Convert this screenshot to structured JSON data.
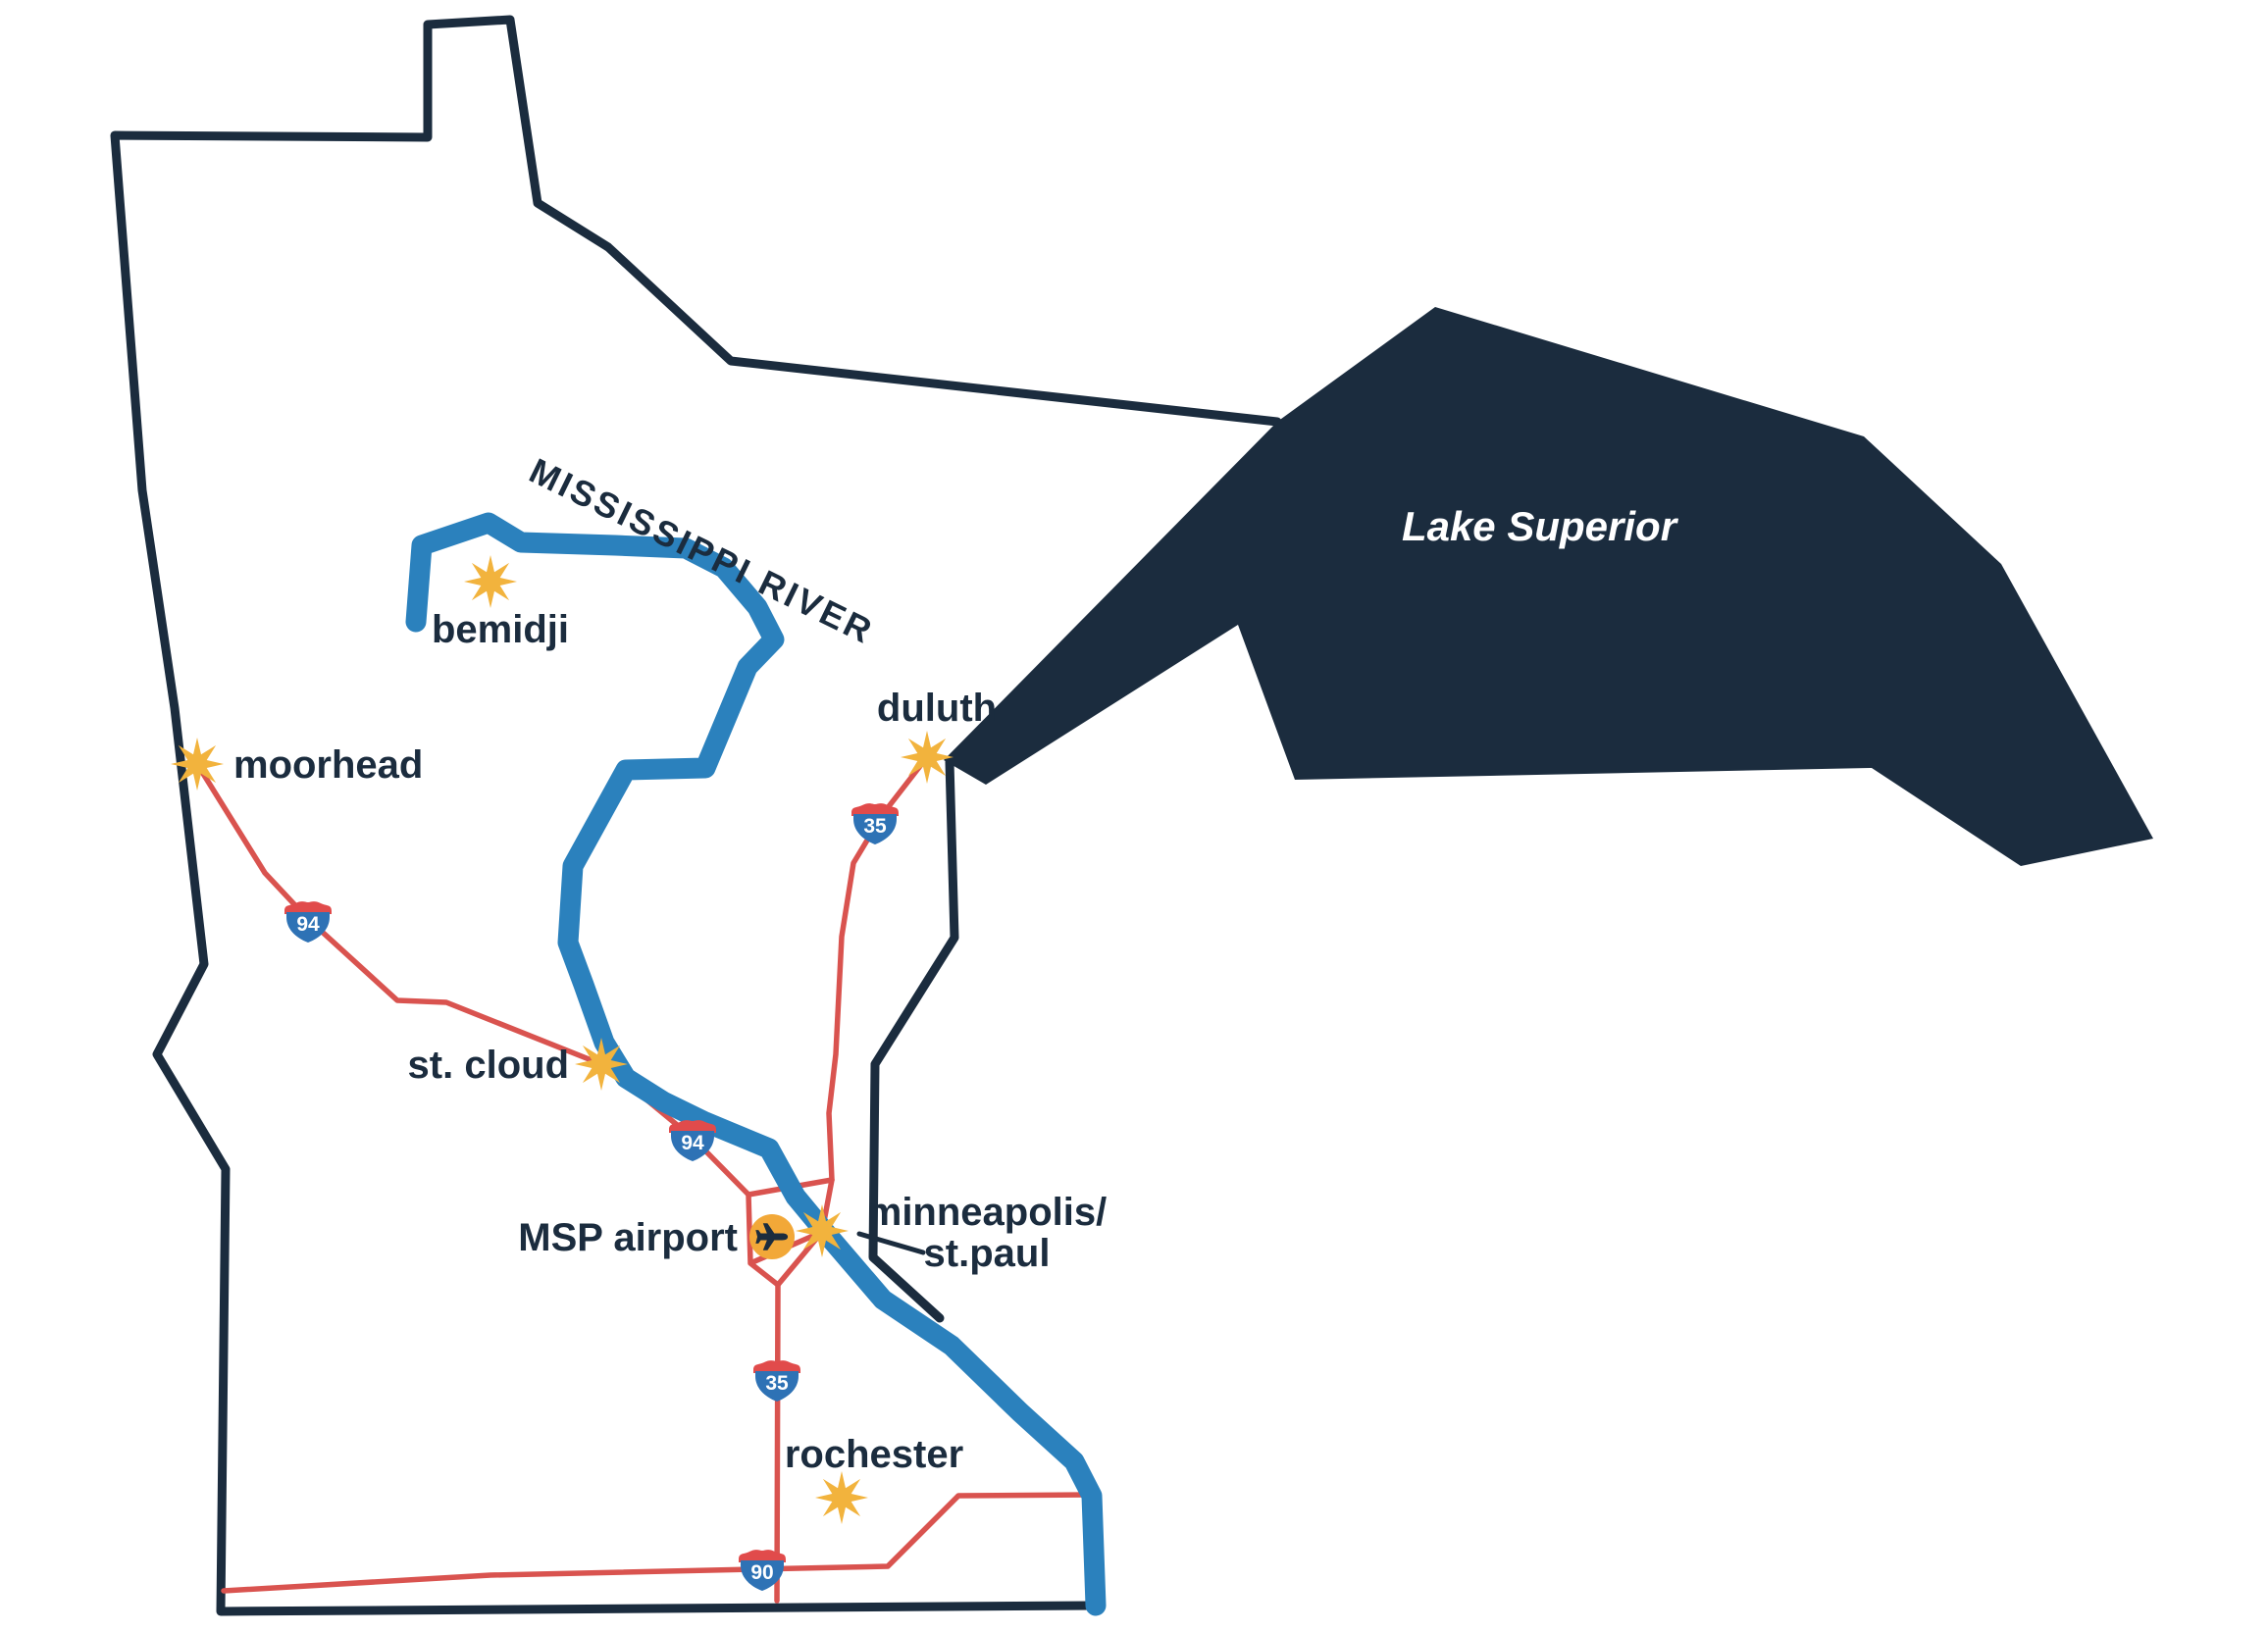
{
  "labels": {
    "bemidji": "bemidji",
    "moorhead": "moorhead",
    "duluth": "duluth",
    "st_cloud": "st. cloud",
    "msp_airport": "MSP airport",
    "minneapolis": "minneapolis/",
    "st_paul": "st.paul",
    "rochester": "rochester",
    "lake": "Lake Superior",
    "river": "MISSISSIPPI RIVER"
  },
  "shields": [
    {
      "number": "94"
    },
    {
      "number": "94"
    },
    {
      "number": "35"
    },
    {
      "number": "35"
    },
    {
      "number": "90"
    }
  ],
  "colors": {
    "navy": "#1B2C3E",
    "river_blue": "#2B81BD",
    "road_red": "#D9534F",
    "shield_blue": "#2E72B5",
    "shield_red": "#E14B4B",
    "star_amber": "#F2B33D",
    "airport_amber": "#F2A838",
    "lake_label_white": "#FFFFFF",
    "background": "#FFFFFF"
  }
}
